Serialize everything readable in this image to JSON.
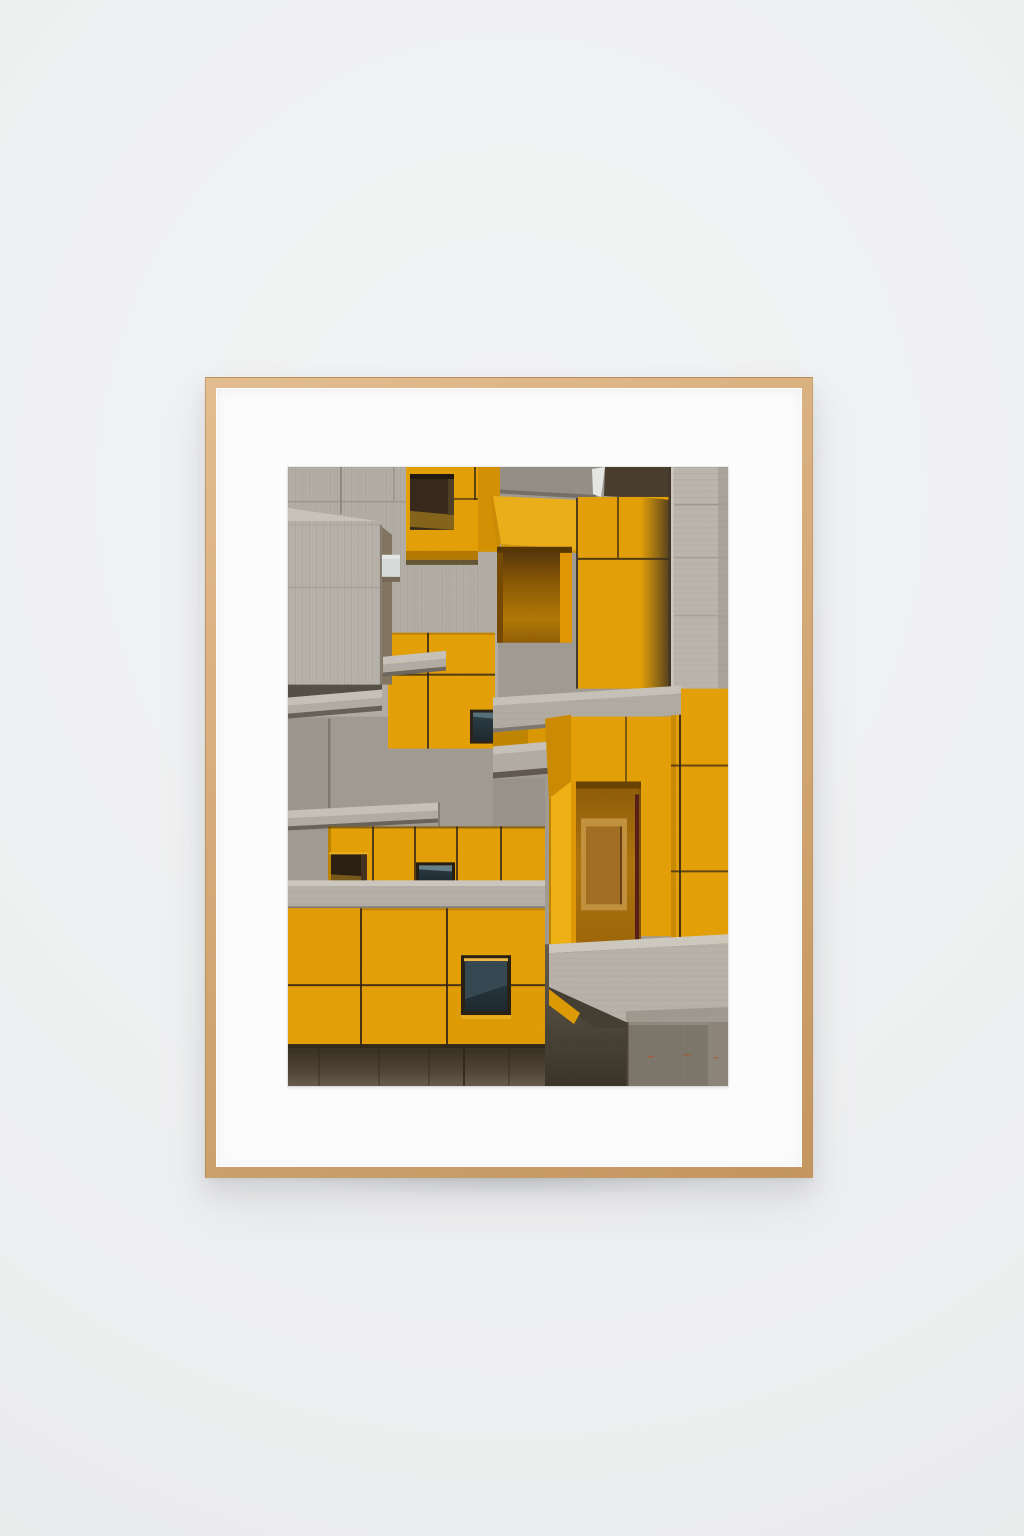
{
  "artwork": {
    "alt": "Framed photograph of a brutalist apartment facade: interlocking concrete volumes, cantilevered slabs and bright yellow panels with recessed balconies and small dark windows",
    "medium": "photographic print",
    "frame_material": "light oak wood",
    "mat_color_name": "white"
  },
  "colors": {
    "wall": "#eef0f1",
    "wood": "#d6ab79",
    "woodDeep": "#c4955f",
    "mat": "#fcfcfd",
    "yellow": "#f1a908",
    "yellowLight": "#f9ba1a",
    "yellowShade": "#d18f05",
    "orangeDeep": "#8a5502",
    "concreteLight": "#d2cdc3",
    "concrete": "#bcb6ad",
    "concreteBg": "#aaa49b",
    "concreteDark": "#8a847b",
    "soffit": "#453b2e",
    "glass": "#2c3a41",
    "seam": "#302519"
  }
}
